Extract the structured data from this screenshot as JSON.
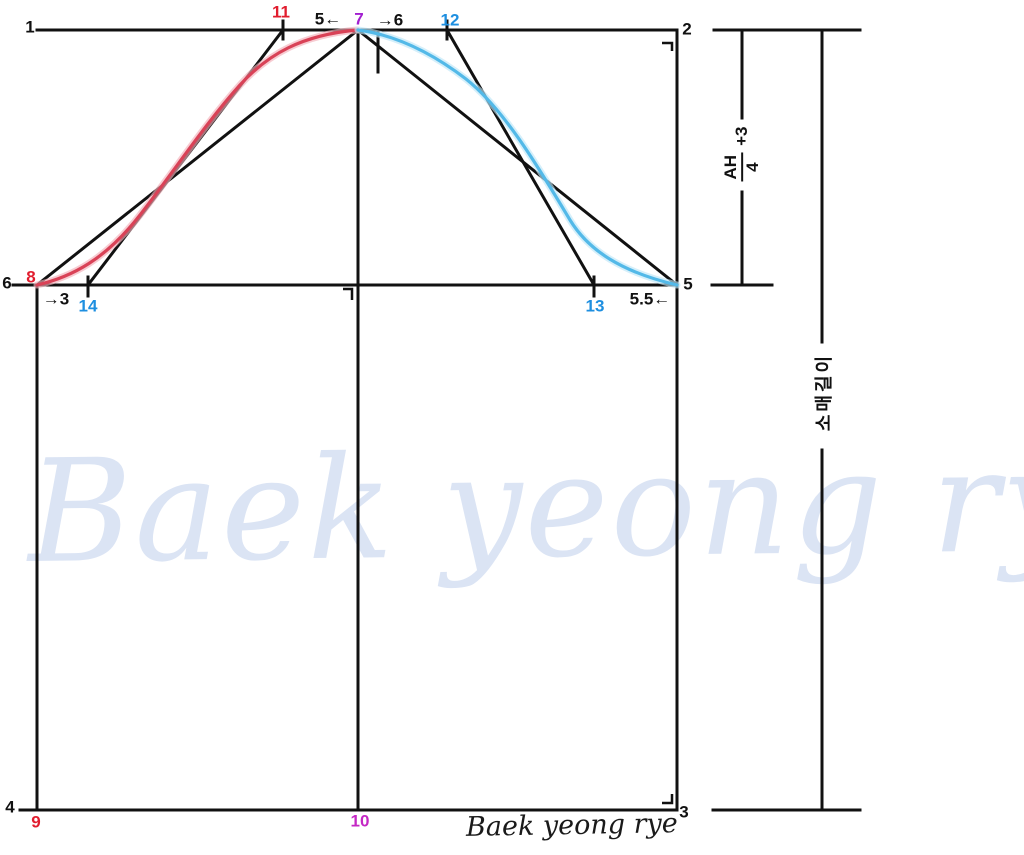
{
  "points": [
    {
      "label": "1",
      "x": 30,
      "y": 27,
      "color": "black"
    },
    {
      "label": "2",
      "x": 687,
      "y": 29,
      "color": "black"
    },
    {
      "label": "3",
      "x": 684,
      "y": 812,
      "color": "black"
    },
    {
      "label": "4",
      "x": 10,
      "y": 807,
      "color": "black"
    },
    {
      "label": "5",
      "x": 688,
      "y": 284,
      "color": "black"
    },
    {
      "label": "6",
      "x": 7,
      "y": 283,
      "color": "black"
    },
    {
      "label": "7",
      "x": 359,
      "y": 19,
      "color": "purple"
    },
    {
      "label": "8",
      "x": 31,
      "y": 277,
      "color": "red"
    },
    {
      "label": "9",
      "x": 36,
      "y": 822,
      "color": "red"
    },
    {
      "label": "10",
      "x": 360,
      "y": 821,
      "color": "magenta"
    },
    {
      "label": "11",
      "x": 281,
      "y": 12,
      "color": "red"
    },
    {
      "label": "12",
      "x": 450,
      "y": 20,
      "color": "blue"
    },
    {
      "label": "13",
      "x": 595,
      "y": 306,
      "color": "blue"
    },
    {
      "label": "14",
      "x": 88,
      "y": 306,
      "color": "blue"
    }
  ],
  "annotations": [
    {
      "name": "ease-5-left",
      "text": "5←",
      "x": 328,
      "y": 19
    },
    {
      "name": "ease-6-right",
      "text": "→6",
      "x": 390,
      "y": 20
    },
    {
      "name": "ease-3-right",
      "text": "→3",
      "x": 56,
      "y": 299
    },
    {
      "name": "ease-5-5-left",
      "text": "5.5←",
      "x": 650,
      "y": 299
    }
  ],
  "measurements": {
    "ah_formula": {
      "numerator": "AH",
      "denominator": "4",
      "suffix": "+3"
    },
    "sleeve_length_label": "소매길이"
  },
  "watermark_text": "Baek yeong rye",
  "signature_text": "Baek yeong rye",
  "colors": {
    "black": "#111111",
    "red": "#e11d2e",
    "blue": "#1e8fe0",
    "purple": "#a21fd0",
    "magenta": "#c427c4",
    "curve_red": "#d94257",
    "curve_red_halo": "#f2b0ba",
    "curve_blue": "#53b9e8",
    "curve_blue_halo": "#bfe6f7",
    "watermark": "#dbe4f4",
    "line": "#111111"
  }
}
